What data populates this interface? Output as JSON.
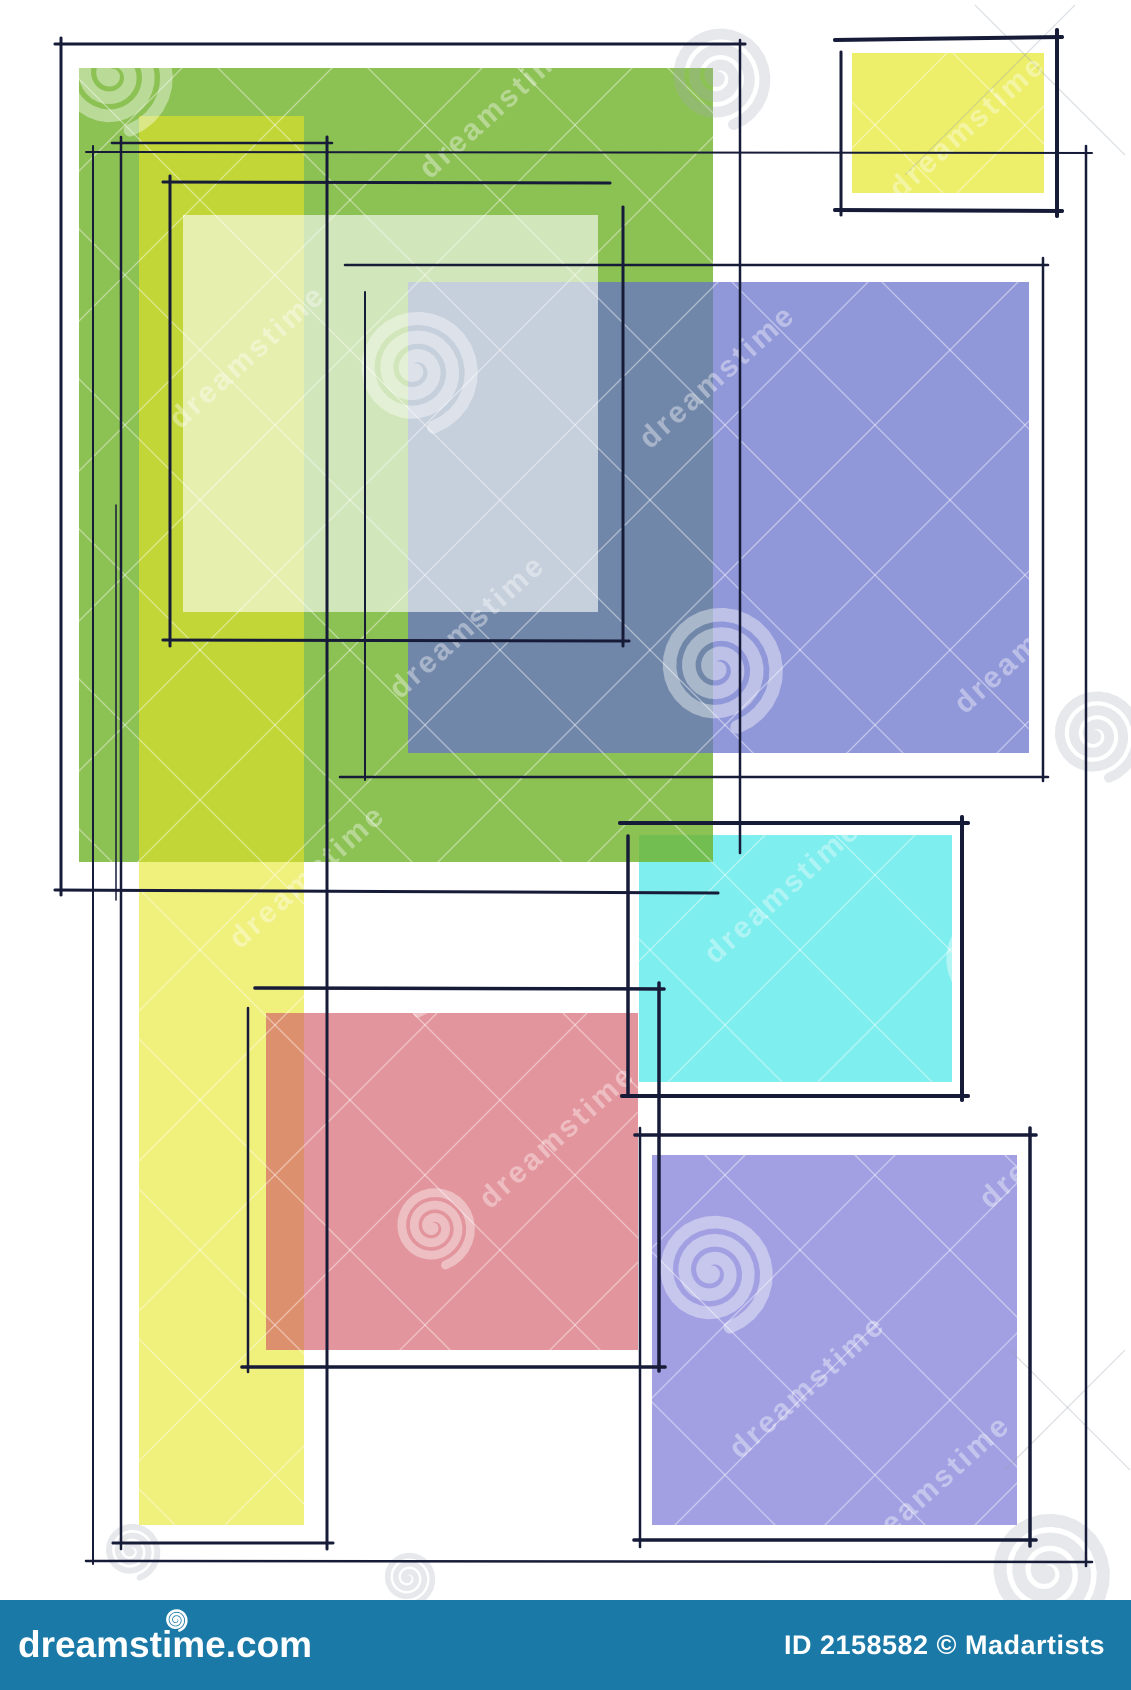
{
  "artwork": {
    "background": "#ffffff",
    "ink_color": "#161b38",
    "canvas_width": 1131,
    "canvas_height": 1600,
    "fills": [
      {
        "name": "cyan-square",
        "x": 639,
        "y": 835,
        "w": 313,
        "h": 247,
        "color": "#7feeee"
      },
      {
        "name": "green-rect",
        "x": 79,
        "y": 68,
        "w": 634,
        "h": 794,
        "color": "rgba(111,178,40,0.8)"
      },
      {
        "name": "yellow-strip",
        "x": 139,
        "y": 116,
        "w": 165,
        "h": 1409,
        "color": "rgba(230,230,37,0.6)"
      },
      {
        "name": "blue-purple-rect",
        "x": 408,
        "y": 282,
        "w": 621,
        "h": 471,
        "color": "rgba(103,112,202,0.72)"
      },
      {
        "name": "pale-overlay-rect",
        "x": 183,
        "y": 215,
        "w": 415,
        "h": 397,
        "color": "rgba(255,255,255,0.6)"
      },
      {
        "name": "red-square",
        "x": 266,
        "y": 1013,
        "w": 372,
        "h": 337,
        "color": "rgba(211,92,103,0.65)"
      },
      {
        "name": "bottom-purple-square",
        "x": 652,
        "y": 1155,
        "w": 365,
        "h": 370,
        "color": "#a2a0e2"
      },
      {
        "name": "top-yellow-square",
        "x": 852,
        "y": 53,
        "w": 192,
        "h": 140,
        "color": "#edef6a"
      }
    ],
    "sketch_strokes": [
      {
        "x1": 55,
        "y1": 44,
        "x2": 745,
        "y2": 44,
        "w": 3
      },
      {
        "x1": 61,
        "y1": 38,
        "x2": 61,
        "y2": 895,
        "w": 3
      },
      {
        "x1": 740,
        "y1": 40,
        "x2": 740,
        "y2": 853,
        "w": 2.5
      },
      {
        "x1": 55,
        "y1": 890,
        "x2": 718,
        "y2": 893,
        "w": 3
      },
      {
        "x1": 112,
        "y1": 143,
        "x2": 332,
        "y2": 143,
        "w": 2.5
      },
      {
        "x1": 121,
        "y1": 137,
        "x2": 121,
        "y2": 1549,
        "w": 2.5
      },
      {
        "x1": 327,
        "y1": 137,
        "x2": 327,
        "y2": 1549,
        "w": 3
      },
      {
        "x1": 113,
        "y1": 1543,
        "x2": 333,
        "y2": 1543,
        "w": 3
      },
      {
        "x1": 116,
        "y1": 505,
        "x2": 116,
        "y2": 900,
        "w": 1.5
      },
      {
        "x1": 163,
        "y1": 182,
        "x2": 610,
        "y2": 183,
        "w": 3
      },
      {
        "x1": 170,
        "y1": 176,
        "x2": 170,
        "y2": 646,
        "w": 3
      },
      {
        "x1": 623,
        "y1": 207,
        "x2": 623,
        "y2": 646,
        "w": 3
      },
      {
        "x1": 163,
        "y1": 640,
        "x2": 629,
        "y2": 641,
        "w": 3
      },
      {
        "x1": 345,
        "y1": 265,
        "x2": 1048,
        "y2": 265,
        "w": 2.5
      },
      {
        "x1": 365,
        "y1": 292,
        "x2": 365,
        "y2": 780,
        "w": 2
      },
      {
        "x1": 1043,
        "y1": 258,
        "x2": 1043,
        "y2": 781,
        "w": 2.5
      },
      {
        "x1": 340,
        "y1": 777,
        "x2": 1048,
        "y2": 777,
        "w": 2.5
      },
      {
        "x1": 86,
        "y1": 152,
        "x2": 1092,
        "y2": 153,
        "w": 2
      },
      {
        "x1": 93,
        "y1": 146,
        "x2": 93,
        "y2": 1564,
        "w": 2
      },
      {
        "x1": 1086,
        "y1": 146,
        "x2": 1086,
        "y2": 1566,
        "w": 2.5
      },
      {
        "x1": 86,
        "y1": 1561,
        "x2": 1092,
        "y2": 1562,
        "w": 2.5
      },
      {
        "x1": 620,
        "y1": 823,
        "x2": 968,
        "y2": 823,
        "w": 4
      },
      {
        "x1": 628,
        "y1": 836,
        "x2": 628,
        "y2": 1094,
        "w": 3.5
      },
      {
        "x1": 962,
        "y1": 817,
        "x2": 962,
        "y2": 1100,
        "w": 4
      },
      {
        "x1": 622,
        "y1": 1096,
        "x2": 968,
        "y2": 1096,
        "w": 4
      },
      {
        "x1": 255,
        "y1": 988,
        "x2": 664,
        "y2": 989,
        "w": 3.5
      },
      {
        "x1": 248,
        "y1": 1008,
        "x2": 248,
        "y2": 1372,
        "w": 2.5
      },
      {
        "x1": 659,
        "y1": 983,
        "x2": 659,
        "y2": 1371,
        "w": 3.5
      },
      {
        "x1": 242,
        "y1": 1367,
        "x2": 665,
        "y2": 1367,
        "w": 3.5
      },
      {
        "x1": 635,
        "y1": 1135,
        "x2": 1036,
        "y2": 1135,
        "w": 3.5
      },
      {
        "x1": 640,
        "y1": 1128,
        "x2": 640,
        "y2": 1547,
        "w": 2.5
      },
      {
        "x1": 1030,
        "y1": 1128,
        "x2": 1030,
        "y2": 1546,
        "w": 3.5
      },
      {
        "x1": 634,
        "y1": 1540,
        "x2": 1036,
        "y2": 1540,
        "w": 3.5
      },
      {
        "x1": 835,
        "y1": 40,
        "x2": 1062,
        "y2": 37,
        "w": 4
      },
      {
        "x1": 841,
        "y1": 52,
        "x2": 841,
        "y2": 215,
        "w": 3
      },
      {
        "x1": 1057,
        "y1": 30,
        "x2": 1057,
        "y2": 216,
        "w": 4
      },
      {
        "x1": 835,
        "y1": 210,
        "x2": 1062,
        "y2": 211,
        "w": 4
      }
    ],
    "watermark": {
      "text": "dreamstime",
      "text_color": "rgba(255,255,255,0.38)",
      "gray_color": "rgba(150,158,175,0.35)",
      "crosshatch_color": "rgba(255,255,255,0.45)",
      "text_tiles": [
        {
          "x": 180,
          "y": 430
        },
        {
          "x": 430,
          "y": 180
        },
        {
          "x": 400,
          "y": 700
        },
        {
          "x": 650,
          "y": 450
        },
        {
          "x": 900,
          "y": 200
        },
        {
          "x": 240,
          "y": 950
        },
        {
          "x": 490,
          "y": 1210
        },
        {
          "x": 715,
          "y": 965
        },
        {
          "x": 965,
          "y": 715
        },
        {
          "x": 740,
          "y": 1460
        },
        {
          "x": 990,
          "y": 1210
        },
        {
          "x": 865,
          "y": 1560
        }
      ],
      "spirals": [
        {
          "x": 112,
          "y": 75,
          "r": 58,
          "tone": "white"
        },
        {
          "x": 415,
          "y": 370,
          "r": 60,
          "tone": "white"
        },
        {
          "x": 718,
          "y": 668,
          "r": 62,
          "tone": "white"
        },
        {
          "x": 998,
          "y": 962,
          "r": 58,
          "tone": "white"
        },
        {
          "x": 712,
          "y": 1272,
          "r": 58,
          "tone": "white"
        },
        {
          "x": 405,
          "y": 973,
          "r": 42,
          "tone": "white"
        },
        {
          "x": 433,
          "y": 1227,
          "r": 40,
          "tone": "white"
        },
        {
          "x": 718,
          "y": 77,
          "r": 50,
          "tone": "gray"
        },
        {
          "x": 1047,
          "y": 1572,
          "r": 60,
          "tone": "gray"
        },
        {
          "x": 131,
          "y": 1551,
          "r": 28,
          "tone": "gray"
        },
        {
          "x": 408,
          "y": 1578,
          "r": 26,
          "tone": "gray"
        },
        {
          "x": 1095,
          "y": 735,
          "r": 45,
          "tone": "gray"
        }
      ],
      "gray_diagonals": [
        {
          "x1": 905,
          "y1": 175,
          "x2": 1075,
          "y2": 5
        },
        {
          "x1": 975,
          "y1": 5,
          "x2": 1125,
          "y2": 155
        },
        {
          "x1": 1005,
          "y1": 1470,
          "x2": 1125,
          "y2": 1350
        },
        {
          "x1": 1010,
          "y1": 1350,
          "x2": 1130,
          "y2": 1470
        }
      ]
    }
  },
  "footer": {
    "bar_color": "#1a79a7",
    "logo": "dreamstime.com",
    "credit": "ID 2158582 © Madartists"
  }
}
